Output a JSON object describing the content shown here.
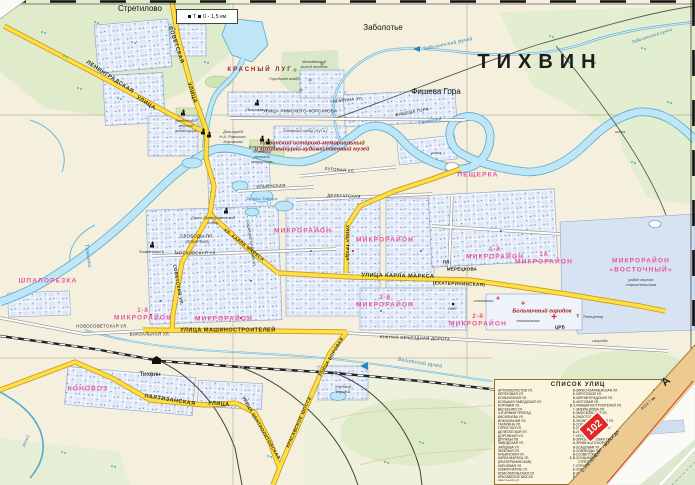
{
  "map_title": {
    "city": "ТИХВИН"
  },
  "scale_box": {
    "icons": "Т",
    "text": "0 - 1,5 км"
  },
  "fold": {
    "route_number": "102",
    "road_letter": "А",
    "road_note": "А114  7 км",
    "direction": "С.-ПЕТЕРБУРГ - ВОЛОГДА"
  },
  "legend": {
    "title": "СПИСОК УЛИЦ",
    "col1": [
      {
        "n": "АРТИЛЛЕРИСТОВ УЛ.",
        "g": "В-3"
      },
      {
        "n": "БЕРЕГОВАЯ УЛ.",
        "g": "Б-2"
      },
      {
        "n": "БОЛЬНИЧНАЯ УЛ.",
        "g": "В-4"
      },
      {
        "n": "БОЛЬШАЯ ЗАВОДСКАЯ УЛ.",
        "g": "Б-4"
      },
      {
        "n": "БОРОВАЯ УЛ.",
        "g": "В-3,4"
      },
      {
        "n": "ВЕСЕННЯЯ УЛ.",
        "g": "Г-3"
      },
      {
        "n": "4-Й АРМИИ ПРОЕЗД",
        "g": "Б-3"
      },
      {
        "n": "ВАСИЛЬЕВА УЛ.",
        "g": "В-2"
      },
      {
        "n": "ВОКЗАЛЬНАЯ УЛ.",
        "g": "Б-3"
      },
      {
        "n": "ГАГАРИНА УЛ.",
        "g": "В-2"
      },
      {
        "n": "ГОРИСТАЯ УЛ.",
        "g": "Б-2"
      },
      {
        "n": "ДЕЛЕГАТСКАЯ УЛ.",
        "g": "В-2"
      },
      {
        "n": "ДОРОЖНАЯ УЛ.",
        "g": "Г-4"
      },
      {
        "n": "ДРУЖБЫ ПЛ.",
        "g": "В-3"
      },
      {
        "n": "ЗАВОДСКАЯ УЛ.",
        "g": "А-3"
      },
      {
        "n": "ЗАЙЦЕВА УЛ.",
        "g": "В-3"
      },
      {
        "n": "ЗЕЛЕНАЯ УЛ.",
        "g": "А-2"
      },
      {
        "n": "ИЛЬИНСКАЯ УЛ.",
        "g": "В-2"
      },
      {
        "n": "КАРЛА МАРКСА УЛ.",
        "g": "Б,В-3"
      },
      {
        "n": "  (ЕКАТЕРИНИНСКАЯ)",
        "g": ""
      },
      {
        "n": "КЛЕНОВАЯ УЛ.",
        "g": "Г-3"
      },
      {
        "n": "КОММУНАРОВ УЛ.",
        "g": "Б-3"
      },
      {
        "n": "КОМСОМОЛЬСКАЯ УЛ.",
        "g": "В-3"
      },
      {
        "n": "КРАСАВСКОЕ ШОССЕ",
        "g": "В-4"
      },
      {
        "n": "КРАСНАЯ УЛ.",
        "g": "Б-2"
      }
    ],
    "col2": [
      {
        "n": "КРАСНОАРМЕЙСКАЯ УЛ.",
        "g": "В-2"
      },
      {
        "n": "КРУПСКОЙ УЛ.",
        "g": "Г-3"
      },
      {
        "n": "ЛЕНИНГРАДСКАЯ УЛ.",
        "g": "А,Б-1,2"
      },
      {
        "n": "ЛУГОВАЯ УЛ.",
        "g": "В-2"
      },
      {
        "n": "МАШИНОСТРОИТЕЛЕЙ УЛ.",
        "g": "Б,В-3"
      },
      {
        "n": "МЕРЕЦКОВА ПЛ.",
        "g": "В-3"
      },
      {
        "n": "МОСКОВСКАЯ УЛ.",
        "g": "Б-2"
      },
      {
        "n": "МОСТОВАЯ УЛ.",
        "g": "В-2"
      },
      {
        "n": "НОВОСОВЕТСКАЯ УЛ.",
        "g": "Б-3"
      },
      {
        "n": "ОРЛОВСКАЯ УЛ.",
        "g": "В-2"
      },
      {
        "n": "ПАРТИЗАНСКАЯ УЛ.",
        "g": "А,Б-4"
      },
      {
        "n": "ПЕЩЕРКА УЛ.",
        "g": "В-2"
      },
      {
        "n": "ПОБЕДЫ УЛ.",
        "g": "В-3"
      },
      {
        "n": "ПРОЛЕТАРСКАЯ УЛ.",
        "g": "Б-2"
      },
      {
        "n": "РИМСКОГО-КОРСАКОВА УЛ.",
        "g": "Б,В-2"
      },
      {
        "n": "САДОВАЯ УЛ.",
        "g": "В-3"
      },
      {
        "n": "СВОБОДЫ ПЛ. (СОБОРНАЯ)",
        "g": "Б-2"
      },
      {
        "n": "СОВЕТСКАЯ УЛ.",
        "g": "Б-1,2,3"
      },
      {
        "n": "СОЦИАЛИСТИЧЕСКАЯ УЛ.",
        "g": "Б-2,3"
      },
      {
        "n": "СТРЕТИЛОВСКАЯ УЛ.",
        "g": "Б-1"
      },
      {
        "n": "ТРУДА УЛ.",
        "g": "В-2,3"
      },
      {
        "n": "УЧЕБНЫЙ ГОРОДОК",
        "g": "В-4"
      },
      {
        "n": "ФИШЕВА ГОРА УЛ.",
        "g": "В-2"
      },
      {
        "n": "ЦЕНТРОЛИТОВСКАЯ УЛ.",
        "g": "Б-4"
      },
      {
        "n": "ШВЕДСКИЙ ПРОЕЗД",
        "g": "В-2"
      },
      {
        "n": "ЮЖНАЯ ОБЪЕЗДНАЯ ДОРОГА",
        "g": "В,Г-4"
      }
    ]
  },
  "labels": [
    {
      "t": "ТИХВИН",
      "x": 540,
      "y": 62,
      "c": "city",
      "n": "city-label"
    },
    {
      "t": "Стретилово",
      "x": 140,
      "y": 9,
      "c": "place",
      "n": "settlement-label"
    },
    {
      "t": "Заболотье",
      "x": 383,
      "y": 28,
      "c": "place",
      "n": "settlement-label"
    },
    {
      "t": "Фишева Гора",
      "x": 436,
      "y": 92,
      "c": "place",
      "n": "settlement-label"
    },
    {
      "t": "Тихвин",
      "x": 150,
      "y": 375,
      "c": "place-sm",
      "n": "station-label"
    },
    {
      "t": "КРАСНЫЙ ЛУГ",
      "x": 260,
      "y": 69,
      "c": "redcaps",
      "n": "area-label"
    },
    {
      "t": "ШПАЛОРЕЗКА",
      "x": 48,
      "y": 282,
      "c": "district"
    },
    {
      "t": "КОНОВОЗ",
      "x": 88,
      "y": 390,
      "c": "district"
    },
    {
      "t": "ПЕЩЕРКА",
      "x": 478,
      "y": 176,
      "c": "district"
    },
    {
      "t": "МИКРОРАЙОН",
      "x": 303,
      "y": 232,
      "c": "district"
    },
    {
      "t": "МИКРОРАЙОН",
      "x": 385,
      "y": 241,
      "c": "district"
    },
    {
      "t": "1-й",
      "x": 143,
      "y": 311,
      "c": "district-sm"
    },
    {
      "t": "МИКРОРАЙОН",
      "x": 143,
      "y": 319,
      "c": "district"
    },
    {
      "t": "МИКРОРАЙОН",
      "x": 224,
      "y": 320,
      "c": "district"
    },
    {
      "t": "3-й",
      "x": 385,
      "y": 298,
      "c": "district-sm"
    },
    {
      "t": "МИКРОРАЙОН",
      "x": 385,
      "y": 306,
      "c": "district"
    },
    {
      "t": "2-й",
      "x": 478,
      "y": 317,
      "c": "district-sm"
    },
    {
      "t": "МИКРОРАЙОН",
      "x": 478,
      "y": 325,
      "c": "district"
    },
    {
      "t": "1-й",
      "x": 495,
      "y": 250,
      "c": "district-sm"
    },
    {
      "t": "МИКРОРАЙОН",
      "x": 495,
      "y": 258,
      "c": "district"
    },
    {
      "t": "1А",
      "x": 544,
      "y": 255,
      "c": "district-sm"
    },
    {
      "t": "МИКРОРАЙОН",
      "x": 544,
      "y": 263,
      "c": "district"
    },
    {
      "t": "МИКРОРАЙОН",
      "x": 641,
      "y": 262,
      "c": "district"
    },
    {
      "t": "«ВОСТОЧНЫЙ»",
      "x": 641,
      "y": 271,
      "c": "district"
    },
    {
      "t": "район жилого",
      "x": 641,
      "y": 280,
      "c": "poi"
    },
    {
      "t": "строительства",
      "x": 641,
      "y": 285,
      "c": "poi"
    },
    {
      "t": "ЛЕНИНГРАДСКАЯ",
      "x": 110,
      "y": 77,
      "r": 33,
      "c": "road"
    },
    {
      "t": "УЛИЦА",
      "x": 146,
      "y": 103,
      "r": 33,
      "c": "road"
    },
    {
      "t": "СОВЕТСКАЯ",
      "x": 176,
      "y": 45,
      "r": 72,
      "c": "road"
    },
    {
      "t": "УЛИЦА",
      "x": 192,
      "y": 93,
      "r": 72,
      "c": "road"
    },
    {
      "t": "СОВЕТСКАЯ УЛ.",
      "x": 178,
      "y": 285,
      "r": 80,
      "c": "road-sm"
    },
    {
      "t": "УЛ. КАРЛА МАРКСА",
      "x": 244,
      "y": 245,
      "r": 38,
      "c": "road-sm"
    },
    {
      "t": "УЛИЦА  КАРЛА  МАРКСА",
      "x": 398,
      "y": 276,
      "r": 1,
      "c": "road"
    },
    {
      "t": "(ЕКАТЕРИНИНСКАЯ)",
      "x": 459,
      "y": 284,
      "r": 2,
      "c": "road-sm"
    },
    {
      "t": "УЛИЦА  МАШИНОСТРОИТЕЛЕЙ",
      "x": 228,
      "y": 330,
      "c": "road"
    },
    {
      "t": "ПАРТИЗАНСКАЯ",
      "x": 170,
      "y": 400,
      "r": 9,
      "c": "road"
    },
    {
      "t": "УЛИЦА",
      "x": 219,
      "y": 404,
      "r": 4,
      "c": "road"
    },
    {
      "t": "КРАСАВСКОЕ ШОССЕ",
      "x": 299,
      "y": 422,
      "r": -66,
      "c": "road-sm"
    },
    {
      "t": "УЛИЦА БОРОВАЯ",
      "x": 331,
      "y": 357,
      "r": -59,
      "c": "road-sm"
    },
    {
      "t": "УЛИЦА ЦЕНТРОЛИТОВСКАЯ",
      "x": 261,
      "y": 428,
      "r": 60,
      "c": "road-sm"
    },
    {
      "t": "УЛИЦА ТРУДА",
      "x": 347,
      "y": 243,
      "r": 90,
      "c": "road-sm"
    },
    {
      "t": "УЛИЦА РИМСКОГО-КОРСАКОВА",
      "x": 300,
      "y": 111,
      "c": "street"
    },
    {
      "t": "ФИШЕВА ГОРА",
      "x": 412,
      "y": 112,
      "r": -10,
      "c": "street"
    },
    {
      "t": "ГАГАРИНА УЛ.",
      "x": 347,
      "y": 100,
      "r": -6,
      "c": "street"
    },
    {
      "t": "МОСКОВСКАЯ УЛ.",
      "x": 196,
      "y": 253,
      "c": "street"
    },
    {
      "t": "ИЛЬИНСКАЯ",
      "x": 271,
      "y": 186,
      "r": -2,
      "c": "street"
    },
    {
      "t": "ДЕЛЕГАТСКАЯ",
      "x": 344,
      "y": 196,
      "r": 2,
      "c": "street"
    },
    {
      "t": "ЛУГОВАЯ УЛ.",
      "x": 340,
      "y": 170,
      "r": 5,
      "c": "street"
    },
    {
      "t": "ВОКЗАЛЬНАЯ УЛ.",
      "x": 150,
      "y": 334,
      "c": "street"
    },
    {
      "t": "НОВОСОВЕТСКАЯ УЛ.",
      "x": 102,
      "y": 326,
      "c": "street"
    },
    {
      "t": "ЮЖНАЯ  ОБЪЕЗДНАЯ  ДОРОГА",
      "x": 415,
      "y": 338,
      "r": 2,
      "c": "street"
    },
    {
      "t": "СВОБОДЫ ПЛ.",
      "x": 197,
      "y": 236,
      "c": "street"
    },
    {
      "t": "(СОБОРНАЯ)",
      "x": 197,
      "y": 242,
      "c": "street-sm"
    },
    {
      "t": "СОЦИАЛИСТИЧЕСКАЯ УЛ.",
      "x": 251,
      "y": 243,
      "r": 82,
      "c": "street-sm"
    },
    {
      "t": "ПЛ.",
      "x": 447,
      "y": 262,
      "c": "street-bold"
    },
    {
      "t": "МЕРЕЦКОВА",
      "x": 462,
      "y": 269,
      "c": "street-bold"
    },
    {
      "t": "Тихвинка",
      "x": 430,
      "y": 121,
      "r": -12,
      "c": "water"
    },
    {
      "t": "Тихвинка",
      "x": 88,
      "y": 256,
      "r": 82,
      "c": "water"
    },
    {
      "t": "Заболотский ручей",
      "x": 448,
      "y": 44,
      "r": -12,
      "c": "water"
    },
    {
      "t": "Заболотский ручей",
      "x": 652,
      "y": 36,
      "r": -18,
      "c": "water-sm"
    },
    {
      "t": "Вязитский ручей",
      "x": 420,
      "y": 363,
      "r": 9,
      "c": "water"
    },
    {
      "t": "Пруды Таборы",
      "x": 262,
      "y": 199,
      "c": "water-sm"
    },
    {
      "t": "ручей",
      "x": 26,
      "y": 441,
      "r": -65,
      "c": "water-sm"
    },
    {
      "t": "шлюз",
      "x": 436,
      "y": 153,
      "c": "poi"
    },
    {
      "t": "шлюз",
      "x": 620,
      "y": 132,
      "c": "poi"
    },
    {
      "t": "Городское кладб.",
      "x": 285,
      "y": 79,
      "c": "poi"
    },
    {
      "t": "Молодежный",
      "x": 314,
      "y": 62,
      "c": "poi"
    },
    {
      "t": "жилой поселок",
      "x": 314,
      "y": 67,
      "c": "poi"
    },
    {
      "t": "Введенский",
      "x": 186,
      "y": 121,
      "c": "poi"
    },
    {
      "t": "женский",
      "x": 186,
      "y": 126,
      "c": "poi"
    },
    {
      "t": "монастырь",
      "x": 186,
      "y": 131,
      "c": "poi"
    },
    {
      "t": "Дом-музей",
      "x": 233,
      "y": 132,
      "c": "poi"
    },
    {
      "t": "Н.А. Римского-",
      "x": 233,
      "y": 137,
      "c": "poi"
    },
    {
      "t": "Корсакова",
      "x": 233,
      "y": 142,
      "c": "poi"
    },
    {
      "t": "Богородичный",
      "x": 262,
      "y": 147,
      "c": "poi"
    },
    {
      "t": "Успенский",
      "x": 262,
      "y": 152,
      "c": "poi"
    },
    {
      "t": "мужской",
      "x": 262,
      "y": 157,
      "c": "poi"
    },
    {
      "t": "монастырь",
      "x": 262,
      "y": 162,
      "c": "poi"
    },
    {
      "t": "Успенский собор (XVI в.)",
      "x": 305,
      "y": 131,
      "c": "poi"
    },
    {
      "t": "Тихвинский историко-мемориальный",
      "x": 312,
      "y": 143,
      "c": "redpoi"
    },
    {
      "t": "и архитектурно-художественный музей",
      "x": 312,
      "y": 149,
      "c": "redpoi"
    },
    {
      "t": "Спасо-Преображенский",
      "x": 213,
      "y": 218,
      "c": "poi"
    },
    {
      "t": "собор",
      "x": 213,
      "y": 223,
      "c": "poi"
    },
    {
      "t": "Знаменская ц.",
      "x": 152,
      "y": 252,
      "c": "poi"
    },
    {
      "t": "Полковая ц.",
      "x": 257,
      "y": 110,
      "c": "poi"
    },
    {
      "t": "Больничный городок",
      "x": 542,
      "y": 311,
      "c": "redpoi"
    },
    {
      "t": "поликлиника",
      "x": 528,
      "y": 321,
      "c": "poi"
    },
    {
      "t": "стоматол.",
      "x": 484,
      "y": 301,
      "c": "poi"
    },
    {
      "t": "ЦРБ",
      "x": 560,
      "y": 327,
      "c": "street-bold"
    },
    {
      "t": "ОКЛ",
      "x": 452,
      "y": 309,
      "c": "street-sm"
    },
    {
      "t": "Телецентр",
      "x": 593,
      "y": 317,
      "c": "poi"
    },
    {
      "t": "Т",
      "x": 578,
      "y": 316,
      "c": "street-bold"
    },
    {
      "t": "огороды",
      "x": 600,
      "y": 341,
      "c": "poi"
    },
    {
      "t": "Учебный",
      "x": 343,
      "y": 387,
      "c": "poi"
    },
    {
      "t": "городок",
      "x": 343,
      "y": 392,
      "c": "poi"
    },
    {
      "t": "+",
      "x": 498,
      "y": 299,
      "c": "rcross",
      "n": "hospital-cross-icon"
    },
    {
      "t": "+",
      "x": 523,
      "y": 304,
      "c": "rcross",
      "n": "hospital-cross-icon"
    },
    {
      "t": "+",
      "x": 554,
      "y": 318,
      "c": "rcross-lg",
      "n": "hospital-cross-icon"
    },
    {
      "t": "",
      "x": 203,
      "y": 133,
      "c": "sym-church",
      "n": "church-icon"
    },
    {
      "t": "",
      "x": 209,
      "y": 136,
      "c": "sym-church",
      "n": "church-icon"
    },
    {
      "t": "",
      "x": 262,
      "y": 140,
      "c": "sym-church",
      "n": "church-icon"
    },
    {
      "t": "",
      "x": 268,
      "y": 143,
      "c": "sym-church",
      "n": "church-icon"
    },
    {
      "t": "",
      "x": 152,
      "y": 246,
      "c": "sym-church",
      "n": "church-icon"
    },
    {
      "t": "",
      "x": 226,
      "y": 212,
      "c": "sym-church",
      "n": "church-icon"
    },
    {
      "t": "",
      "x": 257,
      "y": 104,
      "c": "sym-church",
      "n": "church-icon"
    },
    {
      "t": "",
      "x": 183,
      "y": 114,
      "c": "sym-church",
      "n": "church-icon"
    }
  ]
}
